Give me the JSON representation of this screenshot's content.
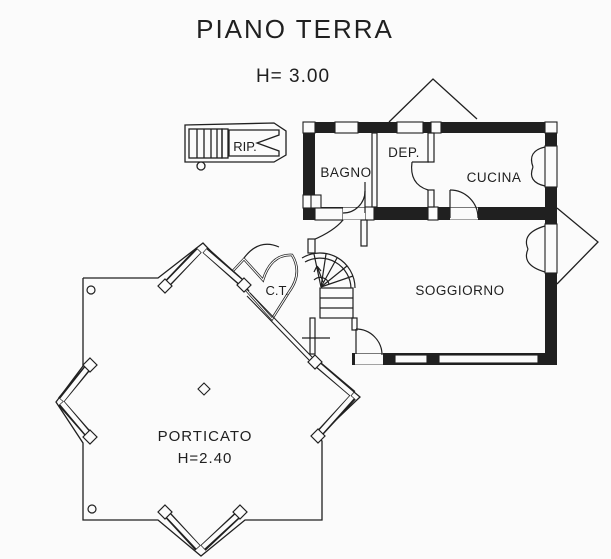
{
  "drawing": {
    "title": "PIANO TERRA",
    "floor_height": "H= 3.00",
    "rooms": {
      "rip": "RIP.",
      "bagno": "BAGNO",
      "dep": "DEP.",
      "cucina": "CUCINA",
      "soggiorno": "SOGGIORNO",
      "ct": "C.T.",
      "porticato": "PORTICATO",
      "porticato_height": "H=2.40"
    },
    "colors": {
      "ink": "#202020",
      "paper": "#fbfbfb"
    }
  }
}
